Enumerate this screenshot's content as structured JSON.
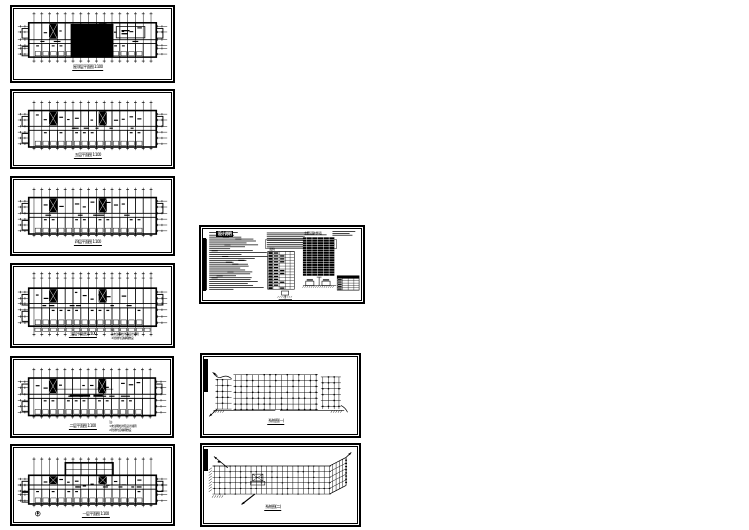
{
  "colors": {
    "paper": "#ffffff",
    "ink": "#000000"
  },
  "sheets": {
    "p1": {
      "title": "屋顶层平面图 1:100"
    },
    "p2": {
      "title": "五层平面图 1:100"
    },
    "p3": {
      "title": "四层平面图 1:100"
    },
    "p4": {
      "title": "三层平面图 1:100",
      "notes": [
        "注:",
        "1.未注明处详见设计说明",
        "2.管线均沿墙暗敷设"
      ]
    },
    "p5": {
      "title": "二层平面图 1:100",
      "notes": [
        "注:",
        "1.未注明处详见设计说明",
        "2.管线均沿墙暗敷设"
      ]
    },
    "p6": {
      "title": "一层平面图 1:100"
    },
    "p7": {
      "heading": "设计说明",
      "table1_caption": "主要设备材料表",
      "table2_caption": "图例"
    },
    "p8": {
      "title": "系统图(一)"
    },
    "p9": {
      "title": "系统图(二)"
    }
  }
}
